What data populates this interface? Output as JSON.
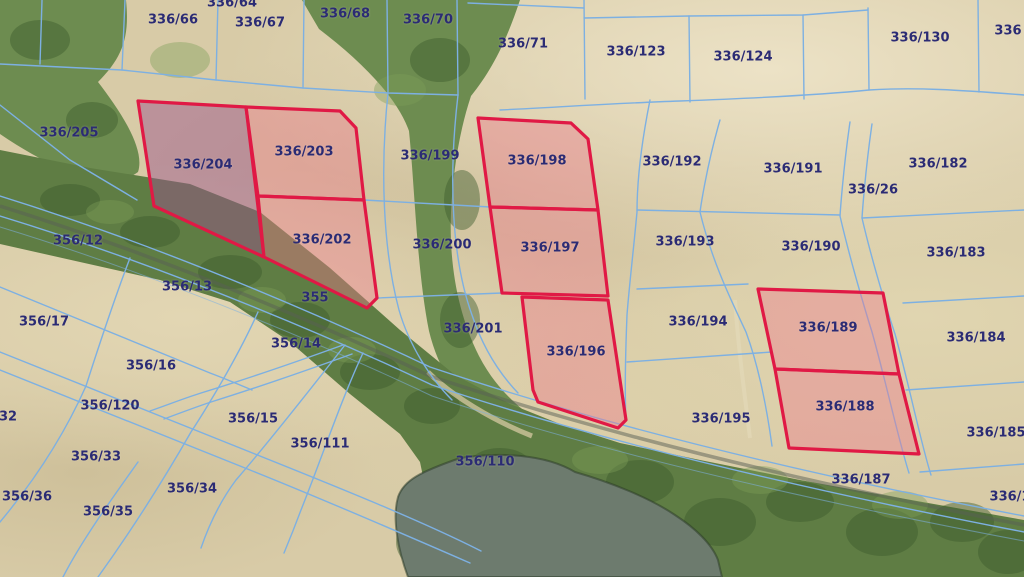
{
  "map": {
    "type": "cadastral-parcel-viewer",
    "selected_parcel": "336/204",
    "highlighted_parcels": [
      "336/204",
      "336/203",
      "336/202",
      "336/198",
      "336/197",
      "336/196",
      "336/189",
      "336/188"
    ],
    "colors": {
      "boundary_line": "#7db0e2",
      "label_text": "#2b2b74",
      "highlight_stroke": "#e01945",
      "highlight_fill": "rgba(236,122,140,0.42)",
      "selected_fill": "rgba(155,82,140,0.47)",
      "water": "#6d7b6e"
    },
    "parcel_labels": [
      {
        "text": "336/64",
        "x": 232,
        "y": 3
      },
      {
        "text": "336/66",
        "x": 173,
        "y": 20
      },
      {
        "text": "336/67",
        "x": 260,
        "y": 23
      },
      {
        "text": "336/68",
        "x": 345,
        "y": 14
      },
      {
        "text": "336/70",
        "x": 428,
        "y": 20
      },
      {
        "text": "336/71",
        "x": 523,
        "y": 44
      },
      {
        "text": "336/123",
        "x": 636,
        "y": 52
      },
      {
        "text": "336/124",
        "x": 743,
        "y": 57
      },
      {
        "text": "336/130",
        "x": 920,
        "y": 38
      },
      {
        "text": "336",
        "x": 1008,
        "y": 31
      },
      {
        "text": "336/205",
        "x": 69,
        "y": 133
      },
      {
        "text": "336/199",
        "x": 430,
        "y": 156
      },
      {
        "text": "336/198",
        "x": 537,
        "y": 161
      },
      {
        "text": "336/192",
        "x": 672,
        "y": 162
      },
      {
        "text": "336/191",
        "x": 793,
        "y": 169
      },
      {
        "text": "336/182",
        "x": 938,
        "y": 164
      },
      {
        "text": "336/26",
        "x": 873,
        "y": 190
      },
      {
        "text": "336/204",
        "x": 203,
        "y": 165
      },
      {
        "text": "336/203",
        "x": 304,
        "y": 152
      },
      {
        "text": "336/202",
        "x": 322,
        "y": 240
      },
      {
        "text": "336/197",
        "x": 550,
        "y": 248
      },
      {
        "text": "336/200",
        "x": 442,
        "y": 245
      },
      {
        "text": "336/193",
        "x": 685,
        "y": 242
      },
      {
        "text": "336/190",
        "x": 811,
        "y": 247
      },
      {
        "text": "336/183",
        "x": 956,
        "y": 253
      },
      {
        "text": "356/12",
        "x": 78,
        "y": 241
      },
      {
        "text": "356/13",
        "x": 187,
        "y": 287
      },
      {
        "text": "355",
        "x": 315,
        "y": 298
      },
      {
        "text": "356/17",
        "x": 44,
        "y": 322
      },
      {
        "text": "356/14",
        "x": 296,
        "y": 344
      },
      {
        "text": "336/201",
        "x": 473,
        "y": 329
      },
      {
        "text": "336/196",
        "x": 576,
        "y": 352
      },
      {
        "text": "336/194",
        "x": 698,
        "y": 322
      },
      {
        "text": "336/189",
        "x": 828,
        "y": 328
      },
      {
        "text": "336/184",
        "x": 976,
        "y": 338
      },
      {
        "text": "356/16",
        "x": 151,
        "y": 366
      },
      {
        "text": "356/120",
        "x": 110,
        "y": 406
      },
      {
        "text": "32",
        "x": 8,
        "y": 417
      },
      {
        "text": "356/15",
        "x": 253,
        "y": 419
      },
      {
        "text": "336/195",
        "x": 721,
        "y": 419
      },
      {
        "text": "336/188",
        "x": 845,
        "y": 407
      },
      {
        "text": "336/185",
        "x": 996,
        "y": 433
      },
      {
        "text": "356/111",
        "x": 320,
        "y": 444
      },
      {
        "text": "356/33",
        "x": 96,
        "y": 457
      },
      {
        "text": "356/110",
        "x": 485,
        "y": 462
      },
      {
        "text": "336/187",
        "x": 861,
        "y": 480
      },
      {
        "text": "356/34",
        "x": 192,
        "y": 489
      },
      {
        "text": "356/36",
        "x": 27,
        "y": 497
      },
      {
        "text": "356/35",
        "x": 108,
        "y": 512
      },
      {
        "text": "336/1",
        "x": 1010,
        "y": 497
      }
    ]
  }
}
